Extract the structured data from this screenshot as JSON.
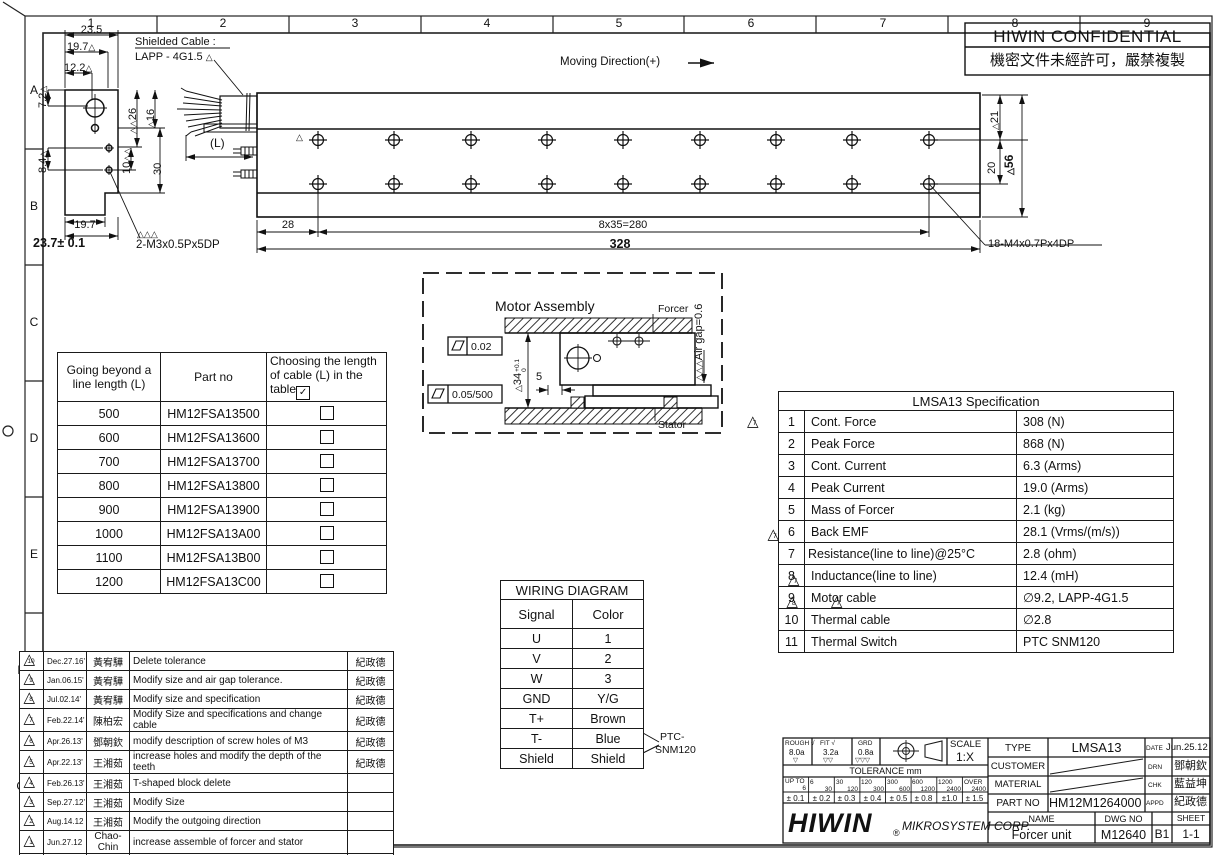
{
  "icons": {
    "triangle": "△",
    "check": "✓"
  },
  "frame": {
    "grid_numbers": [
      "1",
      "2",
      "3",
      "4",
      "5",
      "6",
      "7",
      "8",
      "9"
    ],
    "grid_letters": [
      "A",
      "B",
      "C",
      "D",
      "E",
      "F",
      "G"
    ]
  },
  "confidential": {
    "title": "HIWIN CONFIDENTIAL",
    "subtitle": "機密文件未經許可，嚴禁複製"
  },
  "side_view": {
    "cable_note1": "Shielded Cable :",
    "cable_note2": "LAPP - 4G1.5",
    "d23_5": "23.5",
    "d19_7": "19.7",
    "d12_2": "12.2",
    "d7_2": "7.2",
    "d8_4": "8.4",
    "d26": "26",
    "d16": "16",
    "d10": "10",
    "d30": "30",
    "d19_7b": "19.7",
    "d23_7": "23.7± 0.1",
    "screw_note": "2-M3x0.5Px5DP"
  },
  "rail": {
    "moving_direction": "Moving Direction(+)",
    "length_label": "(L)",
    "d28": "28",
    "d280": "8x35=280",
    "d328": "328",
    "d21": "21",
    "d20": "20",
    "d56": "56",
    "screw_note": "18-M4x0.7Px4DP"
  },
  "assembly": {
    "title": "Motor Assembly",
    "flat1": "0.02",
    "flat2": "0.05/500",
    "d34": "34",
    "d34_tol_top": "+0.1",
    "d34_tol_bot": "0",
    "d5": "5",
    "air_gap": "Air gap=0.6",
    "forcer": "Forcer",
    "stator": "Stator"
  },
  "cable_table": {
    "col1": "Going beyond a line length (L)",
    "col2": "Part no",
    "col3": "Choosing the length of cable (L) in the table",
    "rows": [
      {
        "len": "500",
        "part": "HM12FSA13500"
      },
      {
        "len": "600",
        "part": "HM12FSA13600"
      },
      {
        "len": "700",
        "part": "HM12FSA13700"
      },
      {
        "len": "800",
        "part": "HM12FSA13800"
      },
      {
        "len": "900",
        "part": "HM12FSA13900"
      },
      {
        "len": "1000",
        "part": "HM12FSA13A00"
      },
      {
        "len": "1100",
        "part": "HM12FSA13B00"
      },
      {
        "len": "1200",
        "part": "HM12FSA13C00"
      }
    ]
  },
  "spec_table": {
    "title": "LMSA13 Specification",
    "rows": [
      {
        "no": "1",
        "name": "Cont. Force",
        "value": "308 (N)"
      },
      {
        "no": "2",
        "name": "Peak Force",
        "value": "868 (N)"
      },
      {
        "no": "3",
        "name": "Cont. Current",
        "value": "6.3 (Arms)"
      },
      {
        "no": "4",
        "name": "Peak Current",
        "value": "19.0 (Arms)"
      },
      {
        "no": "5",
        "name": "Mass of Forcer",
        "value": "2.1 (kg)"
      },
      {
        "no": "6",
        "name": "Back EMF",
        "value": "28.1 (Vrms/(m/s))"
      },
      {
        "no": "7",
        "name": "Resistance(line to line)@25°C",
        "value": "2.8 (ohm)"
      },
      {
        "no": "8",
        "name": "Inductance(line to line)",
        "value": "12.4 (mH)"
      },
      {
        "no": "9",
        "name": "Motor cable",
        "value": "∅9.2, LAPP-4G1.5"
      },
      {
        "no": "10",
        "name": "Thermal cable",
        "value": "∅2.8"
      },
      {
        "no": "11",
        "name": "Thermal Switch",
        "value": "PTC SNM120"
      }
    ],
    "flags": {
      "r1": "7",
      "r6": "7",
      "r8": "7",
      "r9a": "8",
      "r9b": "7"
    }
  },
  "wiring": {
    "title": "WIRING DIAGRAM",
    "h1": "Signal",
    "h2": "Color",
    "rows": [
      {
        "s": "U",
        "c": "1"
      },
      {
        "s": "V",
        "c": "2"
      },
      {
        "s": "W",
        "c": "3"
      },
      {
        "s": "GND",
        "c": "Y/G"
      },
      {
        "s": "T+",
        "c": "Brown"
      },
      {
        "s": "T-",
        "c": "Blue"
      },
      {
        "s": "Shield",
        "c": "Shield"
      }
    ],
    "ptc1": "PTC-",
    "ptc2": "SNM120"
  },
  "revisions": {
    "h_item": "ITEM",
    "h_date": "DATE",
    "h_mod": "MODIFIED",
    "h_desc": "DESCRIPTION",
    "h_appd": "APPD",
    "rows": [
      {
        "item": "10",
        "date": "Dec.27.16'",
        "mod": "黃宥驊",
        "desc": "Delete tolerance",
        "appd": "紀政德"
      },
      {
        "item": "9",
        "date": "Jan.06.15'",
        "mod": "黃宥驊",
        "desc": "Modify size and air gap tolerance.",
        "appd": "紀政德"
      },
      {
        "item": "8",
        "date": "Jul.02.14'",
        "mod": "黃宥驊",
        "desc": "Modify size and specification",
        "appd": "紀政德"
      },
      {
        "item": "7",
        "date": "Feb.22.14'",
        "mod": "陳柏宏",
        "desc": "Modify Size and specifications and change cable",
        "appd": "紀政德"
      },
      {
        "item": "6",
        "date": "Apr.26.13'",
        "mod": "鄧朝欽",
        "desc": "modify description of screw holes of M3",
        "appd": "紀政德"
      },
      {
        "item": "5",
        "date": "Apr.22.13'",
        "mod": "王湘茹",
        "desc": "increase holes and modify the depth of the teeth",
        "appd": "紀政德"
      },
      {
        "item": "4",
        "date": "Feb.26.13'",
        "mod": "王湘茹",
        "desc": "T-shaped block delete",
        "appd": ""
      },
      {
        "item": "3",
        "date": "Sep.27.12'",
        "mod": "王湘茹",
        "desc": "Modify Size",
        "appd": ""
      },
      {
        "item": "2",
        "date": "Aug.14.12",
        "mod": "王湘茹",
        "desc": "Modify the outgoing direction",
        "appd": ""
      },
      {
        "item": "1",
        "date": "Jun.27.12",
        "mod": "Chao-Chin",
        "desc": "increase assemble of forcer and stator",
        "appd": ""
      }
    ]
  },
  "title_block": {
    "rough_label": "ROUGH √",
    "fit_label": "FIT √",
    "grd_label": "GRD",
    "rough": "8.0a",
    "fit": "3.2a",
    "grd": "0.8a",
    "rough_marks": "▽",
    "fit_marks": "▽▽",
    "grd_marks": "▽▽▽",
    "scale_label": "SCALE",
    "scale": "1:X",
    "tol_title": "TOLERANCE mm",
    "tol": [
      {
        "t": "UP TO",
        "b": "6",
        "v": "± 0.1"
      },
      {
        "t": "6",
        "b": "30",
        "v": "± 0.2"
      },
      {
        "t": "30",
        "b": "120",
        "v": "± 0.3"
      },
      {
        "t": "120",
        "b": "300",
        "v": "± 0.4"
      },
      {
        "t": "300",
        "b": "600",
        "v": "± 0.5"
      },
      {
        "t": "600",
        "b": "1200",
        "v": "± 0.8"
      },
      {
        "t": "1200",
        "b": "2400",
        "v": "±1.0"
      },
      {
        "t": "OVER",
        "b": "2400",
        "v": "± 1.5"
      }
    ],
    "logo": "HIWIN",
    "logo_reg": "®",
    "logo_sub": "MIKROSYSTEM CORP.",
    "type_label": "TYPE",
    "type": "LMSA13",
    "date_label": "DATE",
    "date": "Jun.25.12",
    "customer_label": "CUSTOMER",
    "drn_label": "DRN",
    "drn": "鄧朝欽",
    "material_label": "MATERIAL",
    "chk_label": "CHK",
    "chk": "藍益坤",
    "partno_label": "PART NO",
    "partno": "HM12M1264000",
    "appd_label": "APPD",
    "appd": "紀政德",
    "name_label": "NAME",
    "dwg_label": "DWG NO",
    "sheet_label": "SHEET",
    "name": "Forcer unit",
    "dwg": "M12640",
    "size": "B1",
    "sheet": "1-1"
  }
}
